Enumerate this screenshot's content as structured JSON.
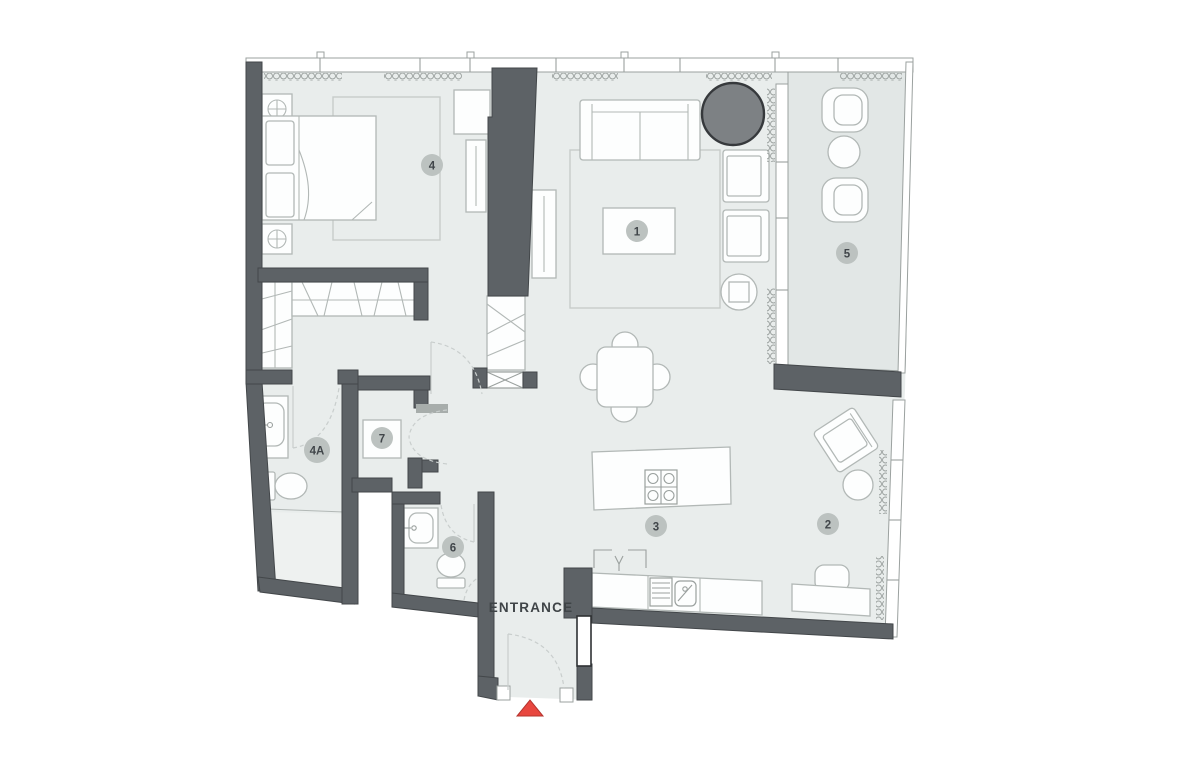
{
  "diagram": {
    "type": "floor-plan",
    "entrance_label": "ENTRANCE"
  },
  "room_badges": [
    {
      "label": "1"
    },
    {
      "label": "2"
    },
    {
      "label": "3"
    },
    {
      "label": "4"
    },
    {
      "label": "4A"
    },
    {
      "label": "5"
    },
    {
      "label": "6"
    },
    {
      "label": "7"
    }
  ],
  "colors": {
    "floor": "#e9edec",
    "balcony_floor": "#e2e7e6",
    "shower_floor": "#eef1f0",
    "wall": "#5d6266",
    "wall_edge": "#43474a",
    "jamb": "#a7adab",
    "furniture_line": "#b2b8b6",
    "appliance_line": "#9aa09e",
    "furniture_fill": "#fdfefe",
    "rug_line": "#c7ccca",
    "glass_line": "#9ba19f",
    "door_line": "#c9cecd",
    "badge_fill": "#bcc2c0",
    "badge_text": "#41464a",
    "label_text": "#3f4447",
    "dark_feature": "#7d8184",
    "dark_feature_edge": "#36393c",
    "accent_red": "#e8473f",
    "accent_red_edge": "#b5342e"
  }
}
